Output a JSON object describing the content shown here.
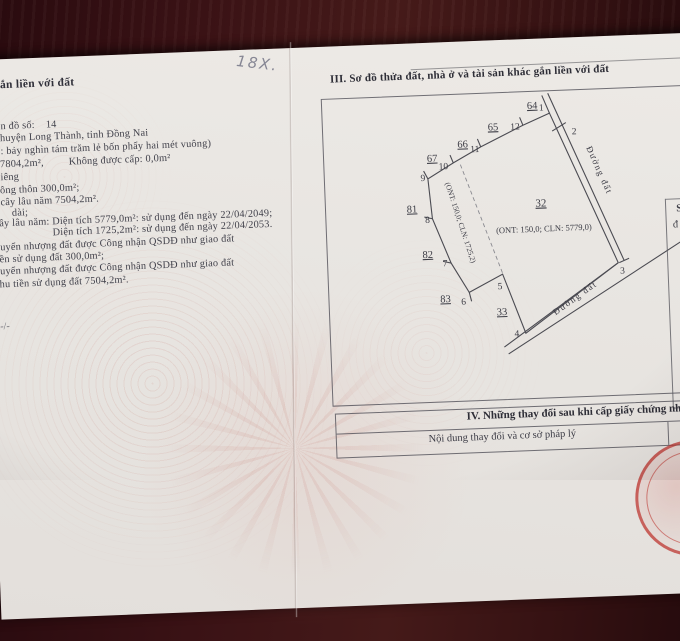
{
  "photo": {
    "handwritten_note": "18X.",
    "page_divider_mark": "-/-",
    "colors": {
      "stamp_red": "#ba2c26",
      "paper": "#e8e5e1",
      "table_wood": "#3a1215"
    }
  },
  "left_page": {
    "heading_fragment": "ắn liền với đất",
    "lines": [
      "n đồ số:    14",
      "huyện Long Thành, tỉnh Đồng Nai",
      ": bảy nghìn tám trăm lẻ bốn phẩy hai mét vuông)",
      "7804,2m²,         Không được cấp: 0,0m²",
      "iêng",
      "ông thôn 300,0m²;",
      "cây lâu năm 7504,2m².",
      "dài;",
      "ây lâu năm: Diện tích 5779,0m²: sử dụng đến ngày 22/04/2049;",
      "Diện tích 1725,2m²: sử dụng đến ngày 22/04/2053.",
      "uyển nhượng đất được Công nhận QSDĐ như giao đất",
      "ền sử dụng đất 300,0m²;",
      "uyển nhượng đất được Công nhận QSDĐ như giao đất",
      "hu tiền sử dụng đất 7504,2m²."
    ]
  },
  "right_page": {
    "section_iii": {
      "title": "III. Sơ đồ thửa đất, nhà ở và tài sản khác gắn liền với đất",
      "diagram": {
        "parcel_number": "32",
        "parcel_area_label": "(ONT: 150,0; CLN: 5779,0)",
        "strip_area_label": "(ONT: 150,0; CLN: 1725,2)",
        "road_label_right": "Đường đất",
        "road_label_bottom": "Đường đất",
        "adjacent_parcels": [
          "64",
          "65",
          "66",
          "67",
          "81",
          "82",
          "83",
          "33"
        ],
        "vertex_numbers": [
          "1",
          "2",
          "3",
          "4",
          "5",
          "6",
          "7",
          "8",
          "9",
          "10",
          "11",
          "12"
        ]
      },
      "edge_box_fragments": [
        "S",
        "đ"
      ]
    },
    "section_iv": {
      "title": "IV. Những thay đổi sau khi cấp giấy chứng nhận",
      "column_header": "Nội dung thay đổi và cơ sở pháp lý"
    }
  }
}
